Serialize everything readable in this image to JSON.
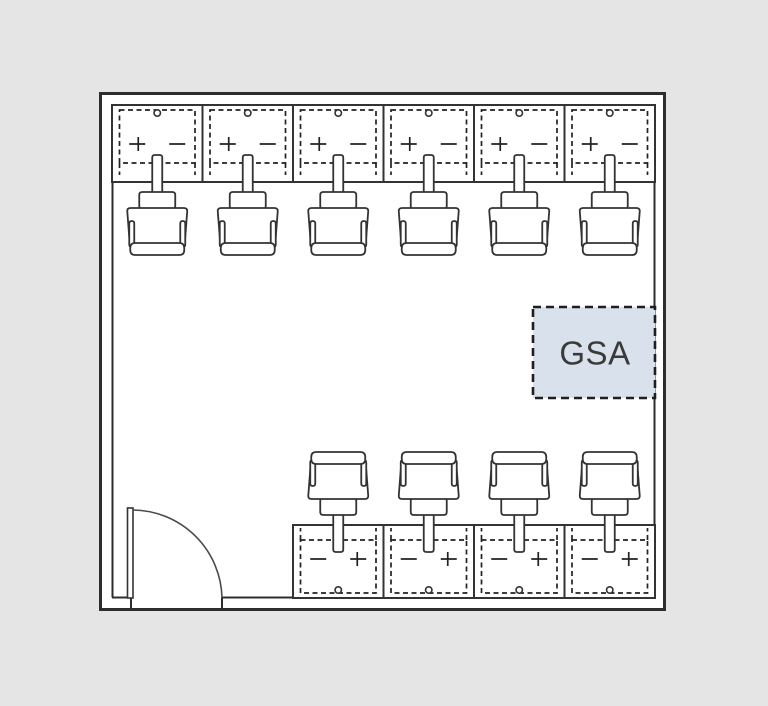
{
  "page": {
    "background": "#e5e5e5"
  },
  "diagram": {
    "type": "office-floorplan",
    "room": {
      "outer": {
        "x": 99,
        "y": 92,
        "w": 567,
        "h": 519
      },
      "inner": {
        "x": 112,
        "y": 105,
        "w": 543,
        "h": 493
      },
      "wall_color": "#2d2d2d",
      "floor_color": "#ffffff"
    },
    "door": {
      "wall": "bottom",
      "opening_start_x": 131,
      "opening_end_x": 222,
      "swing_radius": 90,
      "leaf": {
        "x": 127.5,
        "y": 508,
        "w": 5.5,
        "h": 90
      }
    },
    "desk_rows": [
      {
        "name": "top-row",
        "facing": "down",
        "x1": 112,
        "x2": 655,
        "y1": 105,
        "y2": 182,
        "stations": 6
      },
      {
        "name": "bottom-row",
        "facing": "up",
        "x1": 293,
        "x2": 655,
        "y1": 525,
        "y2": 598,
        "stations": 4
      }
    ],
    "workstations_total": 10,
    "furniture_color": "#333333",
    "gsa_zone": {
      "label": "GSA",
      "x": 533,
      "y": 307,
      "w": 122,
      "h": 91,
      "fill": "#d9e2ec",
      "border_color": "#1f1f1f",
      "label_color": "#3a3a3a"
    }
  }
}
